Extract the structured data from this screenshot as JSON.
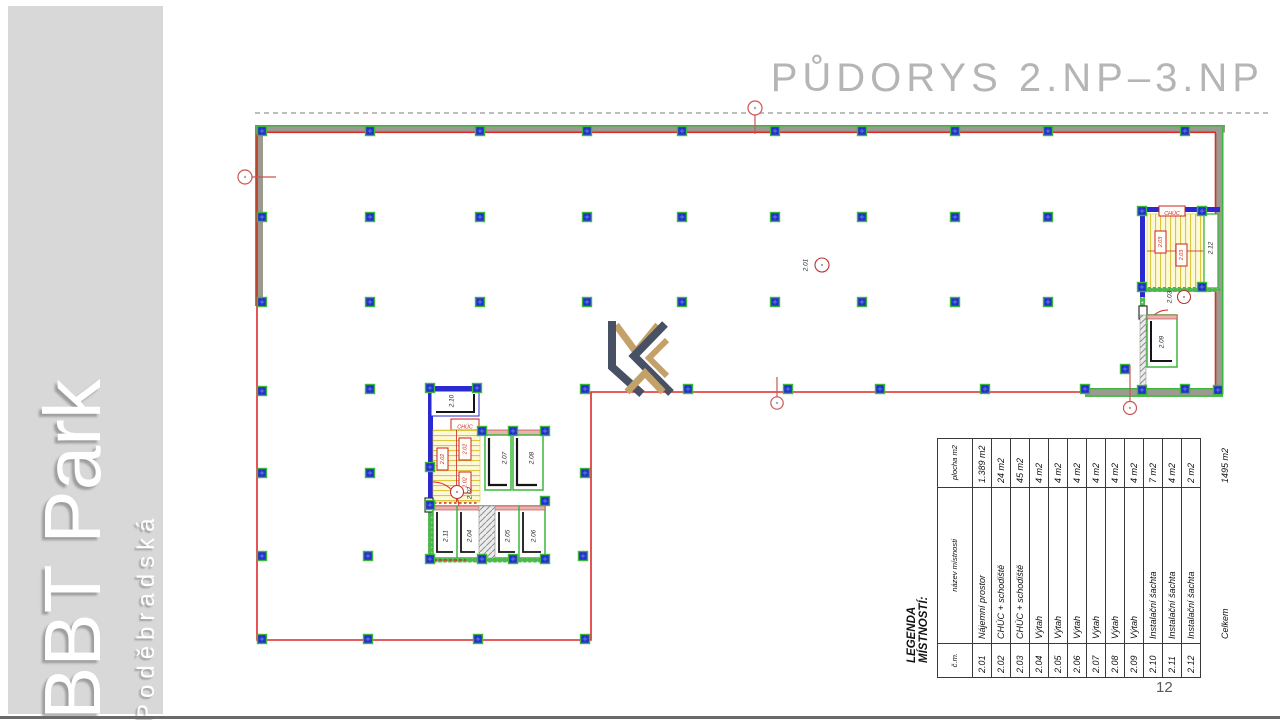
{
  "sidebar": {
    "title": "BBT Park",
    "subtitle": "Poděbradská"
  },
  "header": {
    "title": "PŮDORYS 2.NP–3.NP"
  },
  "page_number": "12",
  "legend": {
    "title": "LEGENDA MÍSTNOSTÍ:",
    "columns": {
      "number": "č.m.",
      "name": "název místnosti",
      "area": "plocha m2"
    },
    "rows": [
      {
        "number": "2.01",
        "name": "Nájemní prostor",
        "area": "1.389 m2"
      },
      {
        "number": "2.02",
        "name": "CHÚC + schodiště",
        "area": "24 m2"
      },
      {
        "number": "2.03",
        "name": "CHÚC + schodiště",
        "area": "45 m2"
      },
      {
        "number": "2.04",
        "name": "Výtah",
        "area": "4 m2"
      },
      {
        "number": "2.05",
        "name": "Výtah",
        "area": "4 m2"
      },
      {
        "number": "2.06",
        "name": "Výtah",
        "area": "4 m2"
      },
      {
        "number": "2.07",
        "name": "Výtah",
        "area": "4 m2"
      },
      {
        "number": "2.08",
        "name": "Výtah",
        "area": "4 m2"
      },
      {
        "number": "2.09",
        "name": "Výtah",
        "area": "4 m2"
      },
      {
        "number": "2.10",
        "name": "Instalační šachta",
        "area": "7 m2"
      },
      {
        "number": "2.11",
        "name": "Instalační šachta",
        "area": "4 m2"
      },
      {
        "number": "2.12",
        "name": "Instalační šachta",
        "area": "2 m2"
      }
    ],
    "total": {
      "name": "Celkem",
      "area": "1495 m2"
    }
  },
  "plan": {
    "labels": {
      "t201": "2.01",
      "t202": "2.02",
      "t203": "2.03",
      "t204": "2.04",
      "t205": "2.05",
      "t206": "2.06",
      "t207": "2.07",
      "t208": "2.08",
      "t209": "2.09",
      "t210": "2.10",
      "t211": "2.11",
      "t212": "2.12",
      "chuc": "CHÚC"
    },
    "colors": {
      "boundary_red": "#dd2a2a",
      "wall_green": "#3cb53c",
      "wall_gray": "#9a9a90",
      "column_blue": "#2230cc",
      "stair_yellow": "#fdf8d8",
      "logo_dark": "#475163",
      "logo_tan": "#c3a169",
      "sidebar_gray": "#d8d8d8",
      "title_gray": "#b5b5b5"
    }
  }
}
